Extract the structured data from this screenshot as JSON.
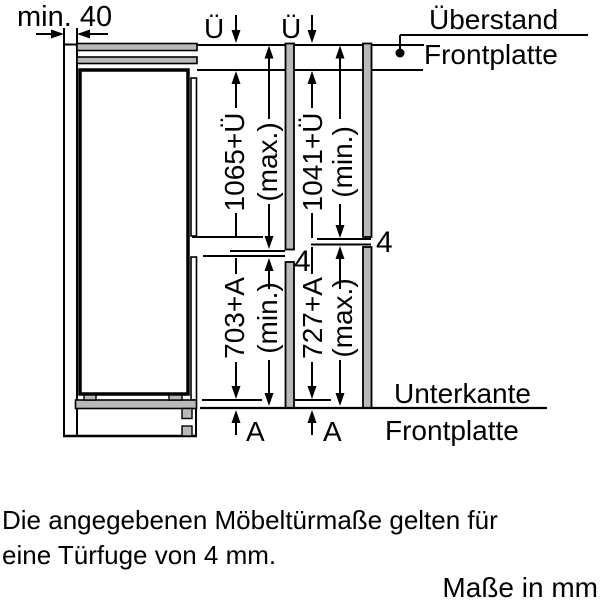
{
  "diagram": {
    "min_clearance": "min. 40",
    "overhang_symbol": "Ü",
    "recess_symbol": "A",
    "door_gap": "4",
    "overhang_label": {
      "line1": "Überstand",
      "line2": "Frontplatte"
    },
    "bottom_edge_label": {
      "line1": "Unterkante",
      "line2": "Frontplatte"
    },
    "dimensions": {
      "upper_door_max": "1065+Ü",
      "upper_door_max_qual": "(max.)",
      "upper_door_min": "1041+Ü",
      "upper_door_min_qual": "(min.)",
      "lower_door_min": "703+A",
      "lower_door_min_qual": "(min.)",
      "lower_door_max": "727+A",
      "lower_door_max_qual": "(max.)"
    }
  },
  "note": {
    "line1": "Die angegebenen Möbeltürmaße gelten für",
    "line2": "eine Türfuge von 4 mm."
  },
  "units_label": "Maße in mm",
  "colors": {
    "ink": "#000000",
    "panel_gray": "#b9b9b9",
    "background": "#ffffff"
  }
}
